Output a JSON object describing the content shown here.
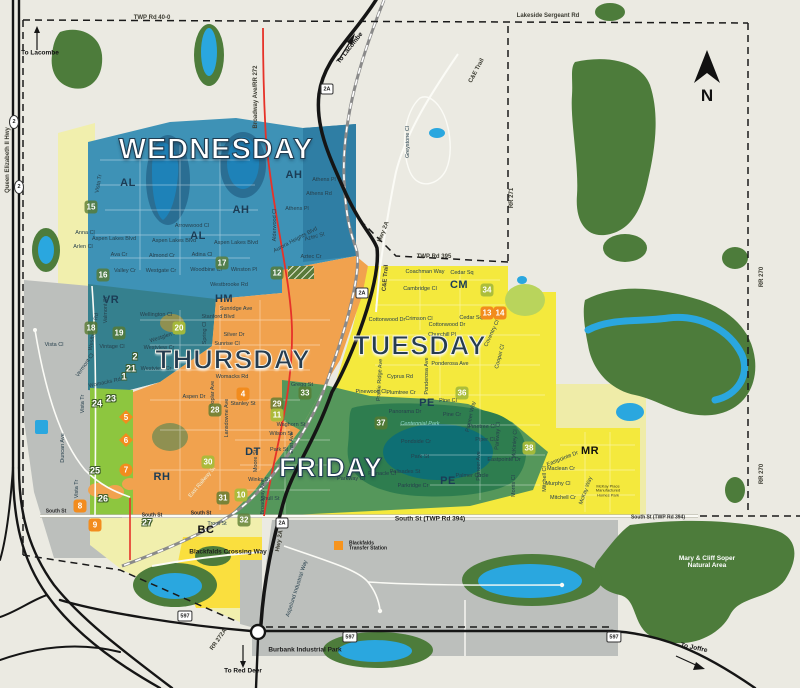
{
  "colors": {
    "bg": "#EBEAE2",
    "wednesday": "#3E92B6",
    "wednesday_dark": "#2F7EA4",
    "vr": "#35808E",
    "thursday": "#F1A24E",
    "tuesday": "#F4E93D",
    "tuesday_pale": "#EFECA8",
    "cm_green": "#B9D45C",
    "friday": "#55975B",
    "park_ring": "#2E7D4F",
    "park_pond": "#0E6F74",
    "lime": "#8DC63F",
    "forest": "#4D7C3B",
    "water": "#2AA7DF",
    "lake": "#1E82B8",
    "lake_halo": "#2A6E93",
    "gray": "#BCBFBC",
    "pale_yellow": "#F1EFAD",
    "bc_yellow": "#FADF3E",
    "olive": "#8F9051",
    "road_black": "#151515",
    "road_white": "#FBFBF6",
    "road_casing": "#B9B9AC",
    "road_red": "#E63229",
    "rail": "#8A8A8A",
    "boundary": "#1A1A1A",
    "transfer_orange": "#F7941D",
    "compass": "#111111"
  },
  "compass": {
    "label": "N"
  },
  "days": [
    {
      "t": "WEDNESDAY",
      "x": 216,
      "y": 150,
      "s": "light big"
    },
    {
      "t": "THURSDAY",
      "x": 233,
      "y": 360,
      "s": "dark"
    },
    {
      "t": "TUESDAY",
      "x": 420,
      "y": 346,
      "s": "dark"
    },
    {
      "t": "FRIDAY",
      "x": 331,
      "y": 468,
      "s": "light"
    }
  ],
  "zone_codes": [
    {
      "t": "AL",
      "x": 128,
      "y": 184
    },
    {
      "t": "AL",
      "x": 198,
      "y": 237
    },
    {
      "t": "AH",
      "x": 241,
      "y": 211
    },
    {
      "t": "AH",
      "x": 294,
      "y": 176
    },
    {
      "t": "VR",
      "x": 111,
      "y": 301
    },
    {
      "t": "HM",
      "x": 224,
      "y": 300
    },
    {
      "t": "CM",
      "x": 459,
      "y": 286
    },
    {
      "t": "PE",
      "x": 427,
      "y": 404
    },
    {
      "t": "PE",
      "x": 448,
      "y": 482
    },
    {
      "t": "DT",
      "x": 253,
      "y": 453
    },
    {
      "t": "RH",
      "x": 162,
      "y": 478
    },
    {
      "t": "BC",
      "x": 206,
      "y": 531,
      "k": 1
    },
    {
      "t": "MR",
      "x": 590,
      "y": 452,
      "k": 1
    }
  ],
  "markers": [
    {
      "n": "15",
      "x": 91,
      "y": 207,
      "c": "green"
    },
    {
      "n": "16",
      "x": 103,
      "y": 275,
      "c": "green"
    },
    {
      "n": "17",
      "x": 222,
      "y": 263,
      "c": "green"
    },
    {
      "n": "12",
      "x": 277,
      "y": 273,
      "c": "green"
    },
    {
      "n": "18",
      "x": 91,
      "y": 328,
      "c": "green"
    },
    {
      "n": "19",
      "x": 119,
      "y": 333,
      "c": "green"
    },
    {
      "n": "20",
      "x": 179,
      "y": 328,
      "c": "yg"
    },
    {
      "n": "2",
      "x": 135,
      "y": 356,
      "c": "out"
    },
    {
      "n": "21",
      "x": 131,
      "y": 368,
      "c": "out"
    },
    {
      "n": "1",
      "x": 124,
      "y": 376,
      "c": "out"
    },
    {
      "n": "24",
      "x": 97,
      "y": 403,
      "c": "out"
    },
    {
      "n": "23",
      "x": 111,
      "y": 398,
      "c": "out"
    },
    {
      "n": "25",
      "x": 95,
      "y": 470,
      "c": "out"
    },
    {
      "n": "26",
      "x": 103,
      "y": 498,
      "c": "out"
    },
    {
      "n": "5",
      "x": 126,
      "y": 417,
      "c": "dia"
    },
    {
      "n": "6",
      "x": 126,
      "y": 440,
      "c": "dia"
    },
    {
      "n": "7",
      "x": 126,
      "y": 470,
      "c": "circ"
    },
    {
      "n": "8",
      "x": 80,
      "y": 506,
      "c": "or"
    },
    {
      "n": "9",
      "x": 95,
      "y": 525,
      "c": "or"
    },
    {
      "n": "27",
      "x": 147,
      "y": 522,
      "c": "out"
    },
    {
      "n": "4",
      "x": 243,
      "y": 394,
      "c": "or"
    },
    {
      "n": "28",
      "x": 215,
      "y": 410,
      "c": "green"
    },
    {
      "n": "29",
      "x": 277,
      "y": 404,
      "c": "green"
    },
    {
      "n": "11",
      "x": 277,
      "y": 415,
      "c": "yg"
    },
    {
      "n": "30",
      "x": 208,
      "y": 462,
      "c": "yg"
    },
    {
      "n": "31",
      "x": 223,
      "y": 498,
      "c": "green"
    },
    {
      "n": "10",
      "x": 241,
      "y": 495,
      "c": "yg"
    },
    {
      "n": "32",
      "x": 244,
      "y": 520,
      "c": "green"
    },
    {
      "n": "33",
      "x": 305,
      "y": 393,
      "c": "green"
    },
    {
      "n": "37",
      "x": 381,
      "y": 423,
      "c": "green"
    },
    {
      "n": "34",
      "x": 487,
      "y": 290,
      "c": "yg"
    },
    {
      "n": "13",
      "x": 487,
      "y": 313,
      "c": "or"
    },
    {
      "n": "14",
      "x": 500,
      "y": 313,
      "c": "or"
    },
    {
      "n": "36",
      "x": 462,
      "y": 393,
      "c": "yg"
    },
    {
      "n": "38",
      "x": 529,
      "y": 448,
      "c": "yg"
    }
  ],
  "shields": [
    {
      "t": "2",
      "x": 14,
      "y": 122,
      "o": 1
    },
    {
      "t": "2",
      "x": 19,
      "y": 187,
      "o": 1
    },
    {
      "t": "2A",
      "x": 327,
      "y": 89
    },
    {
      "t": "2A",
      "x": 362,
      "y": 293
    },
    {
      "t": "2A",
      "x": 282,
      "y": 523
    },
    {
      "t": "597",
      "x": 185,
      "y": 616
    },
    {
      "t": "597",
      "x": 350,
      "y": 637
    },
    {
      "t": "597",
      "x": 614,
      "y": 637
    }
  ],
  "labels": [
    {
      "t": "TWP Rd 40-0",
      "x": 152,
      "y": 18,
      "c": "rd"
    },
    {
      "t": "Lakeside Sergeant Rd",
      "x": 548,
      "y": 16,
      "c": "rd"
    },
    {
      "t": "To Lacombe",
      "x": 40,
      "y": 53,
      "c": "nav"
    },
    {
      "t": "To Lacombe",
      "x": 350,
      "y": 48,
      "r": -52,
      "c": "nav"
    },
    {
      "t": "Queen Elizabeth II Hwy",
      "x": 8,
      "y": 160,
      "r": -90,
      "c": "rd"
    },
    {
      "t": "Broadway Ave/RR 272",
      "x": 256,
      "y": 97,
      "r": -90,
      "c": "rd"
    },
    {
      "t": "Greystone Cl",
      "x": 409,
      "y": 142,
      "r": -90
    },
    {
      "t": "C&E Trail",
      "x": 477,
      "y": 71,
      "r": -62,
      "c": "rd"
    },
    {
      "t": "C&E Trail",
      "x": 386,
      "y": 278,
      "r": -85,
      "c": "rd"
    },
    {
      "t": "RR 271",
      "x": 512,
      "y": 198,
      "r": -90,
      "c": "rd"
    },
    {
      "t": "RR 270",
      "x": 762,
      "y": 277,
      "r": -90,
      "c": "rd"
    },
    {
      "t": "RR 270",
      "x": 762,
      "y": 474,
      "r": -90,
      "c": "rd"
    },
    {
      "t": "TWP Rd 395",
      "x": 434,
      "y": 257,
      "c": "rd"
    },
    {
      "t": "Hwy 2A",
      "x": 384,
      "y": 232,
      "r": -68,
      "c": "rd"
    },
    {
      "t": "Hwy 2A",
      "x": 280,
      "y": 541,
      "r": -80,
      "c": "rd"
    },
    {
      "t": "South St",
      "x": 56,
      "y": 512,
      "c": "rdsm"
    },
    {
      "t": "South St",
      "x": 152,
      "y": 516,
      "c": "rdsm"
    },
    {
      "t": "South St",
      "x": 201,
      "y": 514,
      "c": "rdsm"
    },
    {
      "t": "South St (TWP Rd 394)",
      "x": 430,
      "y": 519,
      "c": "rdb"
    },
    {
      "t": "South St (TWP Rd 394)",
      "x": 658,
      "y": 518,
      "c": "rdsm"
    },
    {
      "t": "Vista Tr",
      "x": 100,
      "y": 184,
      "r": -80
    },
    {
      "t": "Vista Tr",
      "x": 84,
      "y": 404,
      "r": -90
    },
    {
      "t": "Vista Tr",
      "x": 78,
      "y": 489,
      "r": -90
    },
    {
      "t": "Duncan Ave",
      "x": 64,
      "y": 448,
      "r": -90
    },
    {
      "t": "To Red Deer",
      "x": 243,
      "y": 671,
      "c": "nav"
    },
    {
      "t": "RR 272A",
      "x": 219,
      "y": 640,
      "r": -55,
      "c": "rd"
    },
    {
      "t": "To Joffre",
      "x": 694,
      "y": 648,
      "r": 12,
      "c": "nav"
    },
    {
      "t": "Burbank Industrial Park",
      "x": 305,
      "y": 650,
      "c": "rdb"
    },
    {
      "t": "Blackfalds Crossing Way",
      "x": 228,
      "y": 552,
      "c": "rdb"
    },
    {
      "t": "Mary & Cliff Soper Natural Area",
      "x": 707,
      "y": 562,
      "c": "parkw"
    },
    {
      "t": "Centennial Park",
      "x": 420,
      "y": 425,
      "c": "parkt"
    },
    {
      "t": "McKay Place Manufactured Homes Park",
      "x": 608,
      "y": 491,
      "c": "tiny"
    },
    {
      "t": "Blackfalds Transfer Station",
      "x": 370,
      "y": 547,
      "c": "tinyb"
    },
    {
      "t": "East Railway St",
      "x": 203,
      "y": 483,
      "r": -50,
      "c": "stw"
    },
    {
      "t": "Aspelund Industrial Way",
      "x": 298,
      "y": 589,
      "r": -72
    },
    {
      "t": "Anna Cl",
      "x": 85,
      "y": 234
    },
    {
      "t": "Aspen Lakes Blvd",
      "x": 114,
      "y": 240
    },
    {
      "t": "Arlen Cl",
      "x": 83,
      "y": 248
    },
    {
      "t": "Ava Cr",
      "x": 119,
      "y": 256
    },
    {
      "t": "Valley Cr",
      "x": 125,
      "y": 272
    },
    {
      "t": "Westgate Cr",
      "x": 161,
      "y": 272
    },
    {
      "t": "Almond Cr",
      "x": 162,
      "y": 257
    },
    {
      "t": "Adina Cl",
      "x": 202,
      "y": 256
    },
    {
      "t": "Woodbine Cl",
      "x": 206,
      "y": 271
    },
    {
      "t": "Arrowwood Cl",
      "x": 192,
      "y": 227
    },
    {
      "t": "Aspen Lakes Blvd",
      "x": 174,
      "y": 242
    },
    {
      "t": "Aspen Lakes Blvd",
      "x": 236,
      "y": 244
    },
    {
      "t": "Winston Pl",
      "x": 244,
      "y": 271
    },
    {
      "t": "Westbrooke Rd",
      "x": 229,
      "y": 286
    },
    {
      "t": "Athens Pl",
      "x": 324,
      "y": 181
    },
    {
      "t": "Athens Rd",
      "x": 319,
      "y": 195
    },
    {
      "t": "Athens Pl",
      "x": 297,
      "y": 210
    },
    {
      "t": "Alderwood Cl",
      "x": 276,
      "y": 225,
      "r": -90
    },
    {
      "t": "Aurora Heights Blvd",
      "x": 296,
      "y": 241,
      "r": -28
    },
    {
      "t": "Aztec St",
      "x": 315,
      "y": 238,
      "r": -15
    },
    {
      "t": "Aztec Cr",
      "x": 311,
      "y": 258
    },
    {
      "t": "Vista Cl",
      "x": 54,
      "y": 346
    },
    {
      "t": "Valmont St",
      "x": 107,
      "y": 310,
      "r": -90
    },
    {
      "t": "Westbrooke Rd",
      "x": 95,
      "y": 332,
      "r": -80
    },
    {
      "t": "Vintage Cl",
      "x": 112,
      "y": 348
    },
    {
      "t": "Vermont Cl",
      "x": 86,
      "y": 366,
      "r": -55
    },
    {
      "t": "Womacks Rd",
      "x": 105,
      "y": 384,
      "r": -12
    },
    {
      "t": "Wellington Cl",
      "x": 156,
      "y": 316
    },
    {
      "t": "Sunridge Ave",
      "x": 236,
      "y": 310
    },
    {
      "t": "Stanford Blvd",
      "x": 218,
      "y": 318
    },
    {
      "t": "Silver Dr",
      "x": 234,
      "y": 336
    },
    {
      "t": "Sunrise Cl",
      "x": 227,
      "y": 345
    },
    {
      "t": "Spring Cl",
      "x": 206,
      "y": 333,
      "r": -90
    },
    {
      "t": "Westglen Blvd",
      "x": 167,
      "y": 337,
      "r": -18
    },
    {
      "t": "Westview Cr",
      "x": 159,
      "y": 349
    },
    {
      "t": "Westview Cr",
      "x": 156,
      "y": 370
    },
    {
      "t": "Womacks Rd",
      "x": 232,
      "y": 378
    },
    {
      "t": "Gregg St",
      "x": 302,
      "y": 386
    },
    {
      "t": "Poplar Ave",
      "x": 214,
      "y": 394,
      "r": -90
    },
    {
      "t": "Aspen Dr",
      "x": 194,
      "y": 398
    },
    {
      "t": "Stanley St",
      "x": 243,
      "y": 405
    },
    {
      "t": "Lansdowne Ave",
      "x": 228,
      "y": 418,
      "r": -90
    },
    {
      "t": "Waghorn St",
      "x": 291,
      "y": 426
    },
    {
      "t": "Wilson St",
      "x": 281,
      "y": 435
    },
    {
      "t": "Park St",
      "x": 279,
      "y": 451
    },
    {
      "t": "East Ave",
      "x": 293,
      "y": 443,
      "r": -90
    },
    {
      "t": "Winks St",
      "x": 259,
      "y": 481
    },
    {
      "t": "Shull St",
      "x": 270,
      "y": 500
    },
    {
      "t": "Moore St",
      "x": 257,
      "y": 461,
      "r": -90
    },
    {
      "t": "Broadway Ave",
      "x": 264,
      "y": 497,
      "r": -90
    },
    {
      "t": "Trout St",
      "x": 217,
      "y": 525
    },
    {
      "t": "Coachman Way",
      "x": 425,
      "y": 273
    },
    {
      "t": "Cedar Sq",
      "x": 462,
      "y": 274
    },
    {
      "t": "Cambridge Cl",
      "x": 420,
      "y": 290
    },
    {
      "t": "Crimson Cl",
      "x": 419,
      "y": 320
    },
    {
      "t": "Cedar Sq",
      "x": 471,
      "y": 319
    },
    {
      "t": "Cottonwood Dr",
      "x": 387,
      "y": 321
    },
    {
      "t": "Cottonwood Dr",
      "x": 447,
      "y": 326
    },
    {
      "t": "Churchill Pl",
      "x": 442,
      "y": 336
    },
    {
      "t": "Coventry Cl",
      "x": 493,
      "y": 334,
      "r": -65
    },
    {
      "t": "Cooper Cl",
      "x": 501,
      "y": 357,
      "r": -75
    },
    {
      "t": "Ponderosa Ave",
      "x": 450,
      "y": 365
    },
    {
      "t": "Ponderosa Ave",
      "x": 428,
      "y": 376,
      "r": -90
    },
    {
      "t": "Cyprus Rd",
      "x": 400,
      "y": 378
    },
    {
      "t": "Prairie Ridge Ave",
      "x": 381,
      "y": 380,
      "r": -87
    },
    {
      "t": "Pinewood Cl",
      "x": 371,
      "y": 393
    },
    {
      "t": "Plumtree Cr",
      "x": 401,
      "y": 394
    },
    {
      "t": "Pine Cl",
      "x": 448,
      "y": 402
    },
    {
      "t": "Pine Cr",
      "x": 452,
      "y": 416
    },
    {
      "t": "Pioneer Way",
      "x": 472,
      "y": 417,
      "r": -78
    },
    {
      "t": "Pinetree Cl",
      "x": 482,
      "y": 428
    },
    {
      "t": "Piper Cl",
      "x": 485,
      "y": 441
    },
    {
      "t": "Parkway Cl",
      "x": 499,
      "y": 436,
      "r": -87
    },
    {
      "t": "McKinley Cl",
      "x": 516,
      "y": 444,
      "r": -87
    },
    {
      "t": "Eastpointe Dr",
      "x": 504,
      "y": 461
    },
    {
      "t": "Eastpointe Dr",
      "x": 563,
      "y": 460,
      "r": -22
    },
    {
      "t": "Pioneer Ave",
      "x": 480,
      "y": 466,
      "r": -90
    },
    {
      "t": "Palmer Circle",
      "x": 472,
      "y": 477
    },
    {
      "t": "Morris Cl",
      "x": 515,
      "y": 486,
      "r": -90
    },
    {
      "t": "Mitchell Cl",
      "x": 546,
      "y": 479,
      "r": -90
    },
    {
      "t": "Maclean Cr",
      "x": 561,
      "y": 470
    },
    {
      "t": "Murphy Cl",
      "x": 558,
      "y": 485
    },
    {
      "t": "Mitchell Cr",
      "x": 563,
      "y": 499
    },
    {
      "t": "McKay Way",
      "x": 587,
      "y": 491,
      "r": -70
    },
    {
      "t": "Panorama Dr",
      "x": 405,
      "y": 413
    },
    {
      "t": "Pondside Cr",
      "x": 416,
      "y": 443
    },
    {
      "t": "Park St",
      "x": 420,
      "y": 458
    },
    {
      "t": "Palisades St",
      "x": 405,
      "y": 473
    },
    {
      "t": "Parkridge Cr",
      "x": 413,
      "y": 487
    },
    {
      "t": "Pinnacle Cl",
      "x": 382,
      "y": 475
    },
    {
      "t": "Parkway Cl",
      "x": 351,
      "y": 480
    }
  ]
}
